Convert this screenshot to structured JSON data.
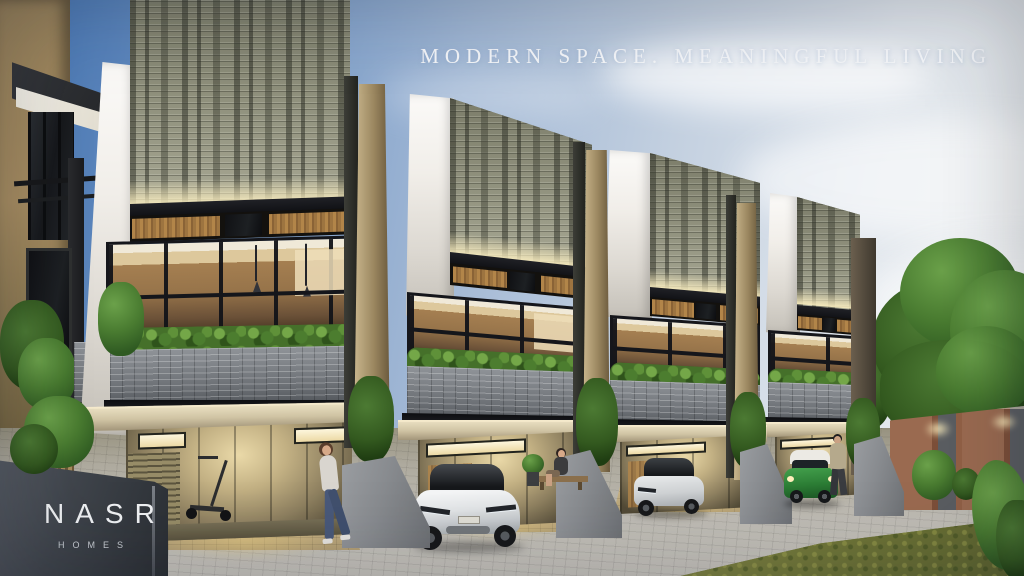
{
  "hero": {
    "tagline": "MODERN SPACE. MEANINGFUL LIVING"
  },
  "brand": {
    "name": "NASR",
    "subtitle": "HOMES"
  },
  "scene": {
    "setting": "dusk exterior render of a row of four modern townhouses with lit interiors",
    "building_count": 4,
    "palette": {
      "sky_blue": "#3f6fae",
      "sky_pale": "#e9eced",
      "breeze_block_facade": "#8e8f7e",
      "warm_interior_light": "#f2e2ae",
      "wood_fin": "#9b8760",
      "planter_gray": "#7d8186",
      "hedge_green": "#4a7c31",
      "white_wall": "#f1eee9",
      "pavement": "#b6b3ab",
      "grass": "#747a3a",
      "copper_fence": "#9a6a50",
      "logo_wall": "#40454c"
    },
    "objects": [
      "townhouse-row",
      "breeze-block-facade",
      "glass-window-band",
      "planter-hedge",
      "garage-carport",
      "white-sedan",
      "silver-hatchback",
      "green-mini-car",
      "standing-woman",
      "sitting-woman",
      "walking-man",
      "kick-scooter",
      "street-pavement",
      "lawn",
      "tree",
      "copper-boundary-wall",
      "brand-wall"
    ]
  }
}
